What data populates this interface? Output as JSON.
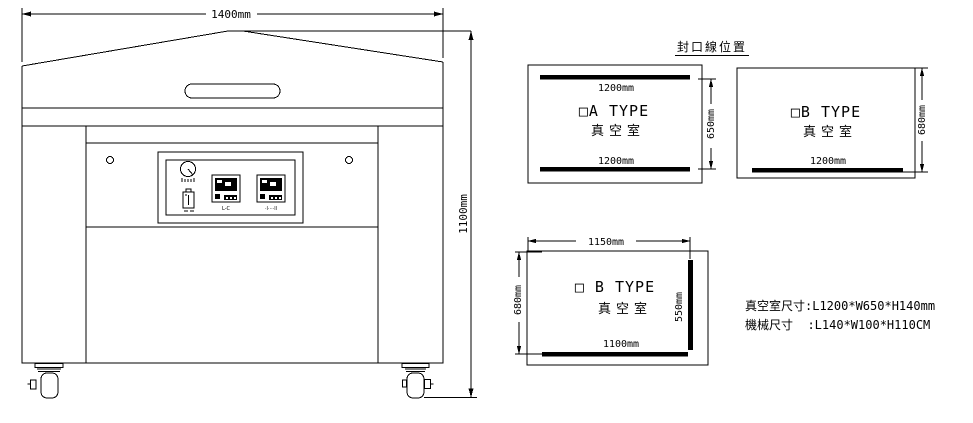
{
  "drawing": {
    "seal_title": "封口線位置",
    "machine": {
      "width_label": "1400mm",
      "height_label": "1100mm",
      "panel": {
        "controller1_label": "L-C",
        "controller2_label": "·l····ll"
      }
    },
    "chamber_a": {
      "type_label": "□A TYPE",
      "name_label": "真空室",
      "top_seal_dim": "1200mm",
      "bottom_seal_dim": "1200mm",
      "height_dim": "650mm"
    },
    "chamber_b1": {
      "type_label": "□B TYPE",
      "name_label": "真空室",
      "seal_dim": "1200mm",
      "height_dim": "680mm"
    },
    "chamber_b2": {
      "type_label": "□ B TYPE",
      "name_label": "真空室",
      "width_dim": "1150mm",
      "height_dim": "680mm",
      "side_seal_dim": "550mm",
      "bottom_seal_dim": "1100mm"
    },
    "specs": {
      "line1": "真空室尺寸:L1200*W650*H140mm",
      "line2": "機械尺寸  :L140*W100*H110CM"
    },
    "colors": {
      "ink": "#000000",
      "background": "#ffffff"
    }
  }
}
